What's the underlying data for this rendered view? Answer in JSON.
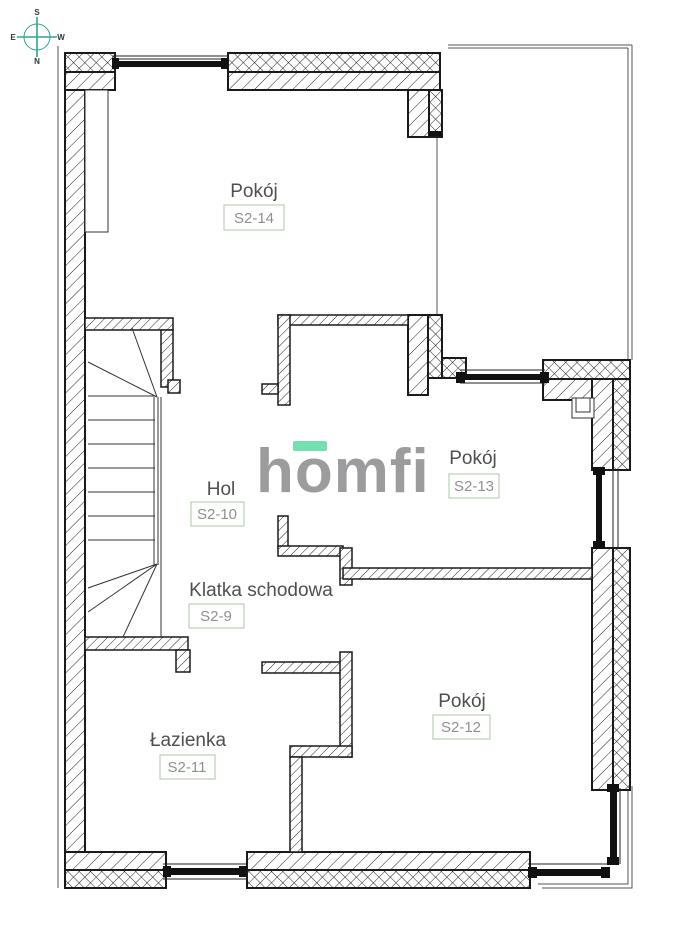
{
  "plan_type": "floor-plan",
  "compass": {
    "top": "S",
    "left": "E",
    "right": "W",
    "bottom": "N"
  },
  "logo": {
    "text": "homfi"
  },
  "rooms": [
    {
      "name": "Pokój",
      "code": "S2-14"
    },
    {
      "name": "Pokój",
      "code": "S2-13"
    },
    {
      "name": "Hol",
      "code": "S2-10"
    },
    {
      "name": "Klatka schodowa",
      "code": "S2-9"
    },
    {
      "name": "Łazienka",
      "code": "S2-11"
    },
    {
      "name": "Pokój",
      "code": "S2-12"
    }
  ],
  "colors": {
    "accent_mint": "#74dfb0",
    "logo_grey": "#9c9c9e",
    "badge_border": "#adc5a9",
    "compass_teal": "#2fa391",
    "ink": "#1a1a1a"
  }
}
